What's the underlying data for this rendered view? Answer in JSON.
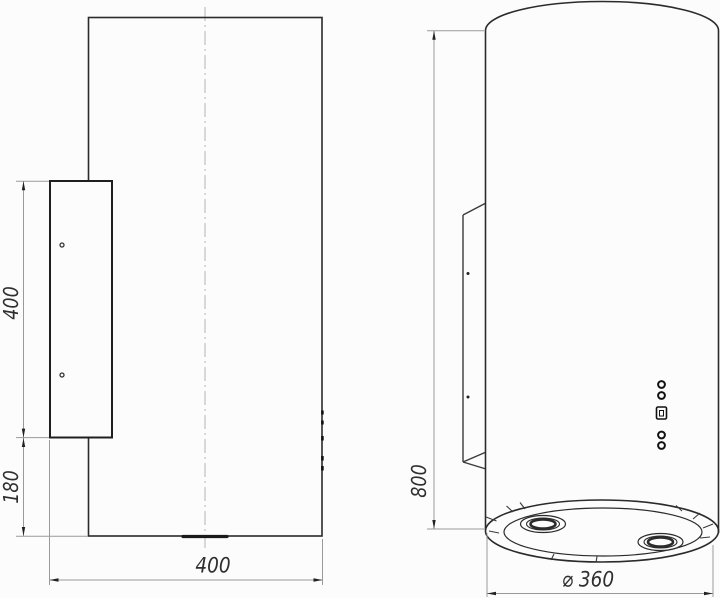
{
  "drawing": {
    "side_view": {
      "dim_bracket_height": "400",
      "dim_bottom_offset": "180",
      "dim_depth": "400"
    },
    "front_view": {
      "dim_body_height": "800",
      "dim_diameter": "⌀ 360"
    },
    "icons": {
      "controls": [
        "round-button-icon",
        "round-button-icon",
        "display-icon",
        "round-button-icon",
        "round-button-icon"
      ]
    },
    "colors": {
      "background": "#fcfcfc",
      "object_line": "#2b2b2b",
      "bracket_line": "#1f1f1f",
      "dim_line": "#9a9a9a",
      "centerline": "#b3b3b3",
      "text": "#2f2f2f"
    }
  }
}
